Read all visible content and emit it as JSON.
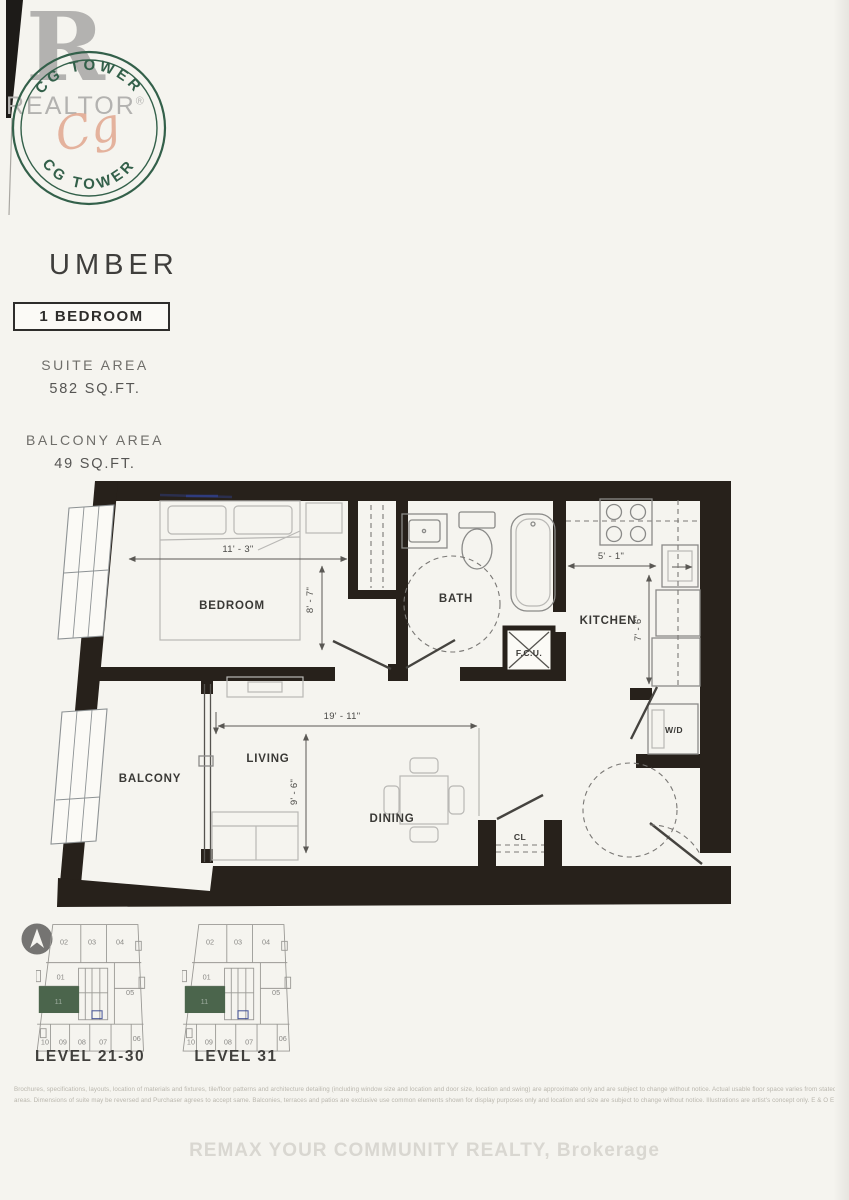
{
  "branding": {
    "realtor_r": "R",
    "realtor_label": "REALTOR",
    "realtor_reg": "®",
    "seal_top_text": "CG TOWER",
    "seal_bottom_text": "CG TOWER",
    "seal_signature": "Cg",
    "seal_color": "#33604a",
    "signature_color": "#e2a78f"
  },
  "header": {
    "title": "UMBER",
    "type_badge": "1 BEDROOM",
    "suite_area_label": "SUITE AREA",
    "suite_area_value": "582 SQ.FT.",
    "balcony_area_label": "BALCONY AREA",
    "balcony_area_value": "49 SQ.FT."
  },
  "floorplan": {
    "wall_color": "#27211b",
    "rooms": {
      "bedroom": "BEDROOM",
      "bath": "BATH",
      "kitchen": "KITCHEN",
      "living": "LIVING",
      "dining": "DINING",
      "balcony": "BALCONY",
      "closet": "CL",
      "fan_coil_unit": "F.C.U.",
      "washer_dryer": "W/D"
    },
    "dimensions": {
      "bedroom_width": "11' - 3\"",
      "bedroom_depth": "8' - 7\"",
      "living_width": "19' - 11\"",
      "living_depth": "9' - 6\"",
      "kitchen_width": "5' - 1\"",
      "kitchen_depth": "7' - 6\""
    }
  },
  "keyplans": {
    "highlight_color": "#4b654c",
    "plans": [
      {
        "label": "LEVEL 21-30",
        "highlight_unit": "11",
        "units": [
          "02",
          "03",
          "04",
          "01",
          "05",
          "10",
          "09",
          "08",
          "07",
          "06"
        ]
      },
      {
        "label": "LEVEL 31",
        "highlight_unit": "11",
        "units": [
          "02",
          "03",
          "04",
          "01",
          "05",
          "10",
          "09",
          "08",
          "07",
          "06"
        ]
      }
    ]
  },
  "footer": {
    "disclaimer_line1": "Brochures, specifications, layouts, location of materials and fixtures, tile/floor patterns and architecture detailing (including window size and location and door size, location and swing) are approximate only and are subject to change without notice. Actual usable floor space varies from stated",
    "disclaimer_line2": "areas. Dimensions of suite may be reversed and Purchaser agrees to accept same. Balconies, terraces and patios are exclusive use common elements shown for display purposes only and location and size are subject to change without notice. Illustrations are artist's concept only. E & O E",
    "brokerage": "REMAX YOUR COMMUNITY REALTY, Brokerage"
  }
}
